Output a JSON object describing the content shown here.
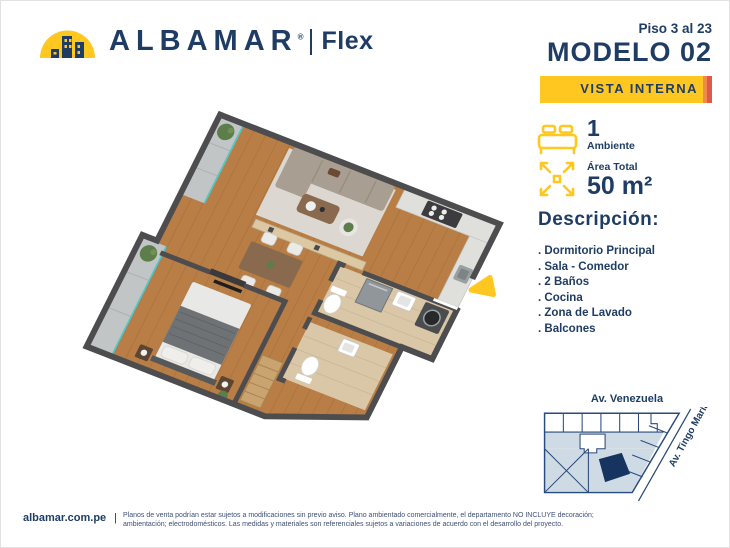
{
  "brand": {
    "name": "ALBAMAR",
    "registered_mark": "®",
    "sub_brand": "Flex"
  },
  "header": {
    "floors": "Piso 3 al 23",
    "model": "MODELO 02",
    "view_badge": "VISTA INTERNA"
  },
  "specs": {
    "ambientes": {
      "value": "1",
      "label": "Ambiente"
    },
    "area": {
      "label": "Área Total",
      "value": "50 m²"
    }
  },
  "description": {
    "title": "Descripción:",
    "items": [
      ". Dormitorio Principal",
      ". Sala - Comedor",
      ". 2 Baños",
      ". Cocina",
      ". Zona de Lavado",
      ". Balcones"
    ]
  },
  "map": {
    "street_top": "Av. Venezuela",
    "street_right": "Av. Tingo María"
  },
  "footer": {
    "website": "albamar.com.pe",
    "divider": "|",
    "disclaimer_line1": "Planos de venta podrían estar sujetos a modificaciones sin previo aviso. Plano ambientado comercialmente, el departamento NO INCLUYE decoración;",
    "disclaimer_line2": "ambientación; electrodomésticos. Las medidas y materiales son referenciales sujetos a variaciones de acuerdo con el desarrollo del proyecto."
  },
  "colors": {
    "navy": "#1F3D64",
    "yellow": "#FFC71F",
    "red_accent": "#E2574C",
    "orange_accent": "#F08A4B",
    "wall": "#4D4D4F",
    "wood": "#B97E46",
    "bath_tile": "#D9C7A7",
    "balcony_tile": "#C2C5C6",
    "glass_teal": "#53C6C9",
    "map_light": "#CFDBE4",
    "map_site": "#16345F"
  }
}
